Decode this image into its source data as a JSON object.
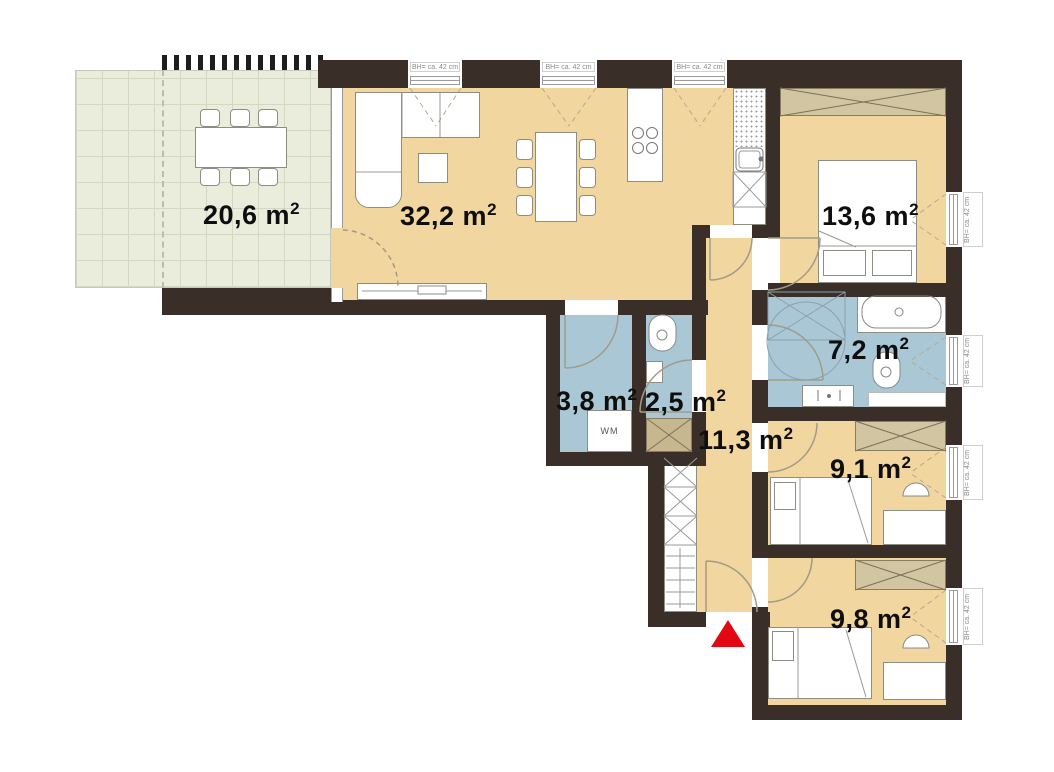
{
  "rooms": {
    "terrace": {
      "area": "20,6 m",
      "sup": "2"
    },
    "living": {
      "area": "32,2 m",
      "sup": "2"
    },
    "bedroom": {
      "area": "13,6 m",
      "sup": "2"
    },
    "bathroom": {
      "area": "7,2 m",
      "sup": "2"
    },
    "shower_wc": {
      "area": "3,8 m",
      "sup": "2"
    },
    "wc": {
      "area": "2,5 m",
      "sup": "2"
    },
    "hallway": {
      "area": "11,3 m",
      "sup": "2"
    },
    "room_91": {
      "area": "9,1 m",
      "sup": "2"
    },
    "room_98": {
      "area": "9,8 m",
      "sup": "2"
    }
  },
  "window_label": "BH= ca. 42 cm",
  "washing_machine": "WM",
  "colors": {
    "wall": "#3a2e28",
    "floor": "#f1d6a0",
    "wet_room": "#a9c7d5",
    "terrace": "#eaecdc",
    "wardrobe": "#d1c5a2",
    "cabinet": "#c7b78e",
    "entrance_marker": "#e30613"
  }
}
